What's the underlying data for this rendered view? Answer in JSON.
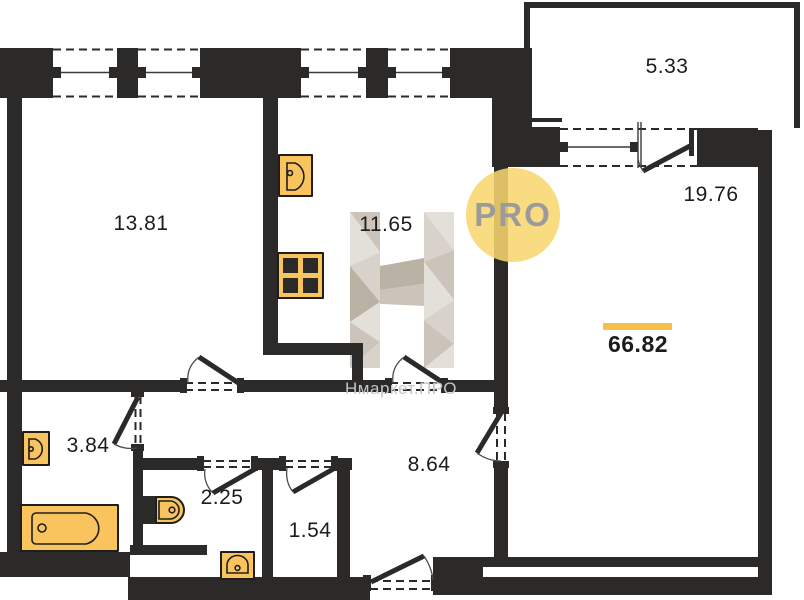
{
  "plan": {
    "brand": {
      "watermark_text": "Нмаркет.ПРО",
      "badge_text": "PRO"
    },
    "total": {
      "area": "66.82"
    },
    "rooms": [
      {
        "name": "room",
        "area": "13.81"
      },
      {
        "name": "kitchen",
        "area": "11.65"
      },
      {
        "name": "balcony",
        "area": "5.33"
      },
      {
        "name": "living-room",
        "area": "19.76"
      },
      {
        "name": "bathroom",
        "area": "3.84"
      },
      {
        "name": "wc",
        "area": "2.25"
      },
      {
        "name": "closet",
        "area": "1.54"
      },
      {
        "name": "hallway",
        "area": "8.64"
      }
    ],
    "fixtures": [
      "kitchen-sink",
      "stove",
      "washbasin",
      "bathtub",
      "toilet",
      "hall-washbasin"
    ],
    "colors": {
      "wall_color": "#2b2a29",
      "fixture_fill": "#f9c45e",
      "fixture_stroke": "#1f1e1d",
      "accent_bar": "#f5c04a",
      "badge_bg": "#f8d66e",
      "badge_text_color": "#9b9b9b",
      "watermark_text_color": "#c6c4c2",
      "label_color": "#1c1c1c",
      "logo_light": "#e2ded8",
      "logo_pale": "#d7d1c9",
      "logo_mid": "#cac2b8",
      "logo_dark": "#b9afa3"
    }
  }
}
